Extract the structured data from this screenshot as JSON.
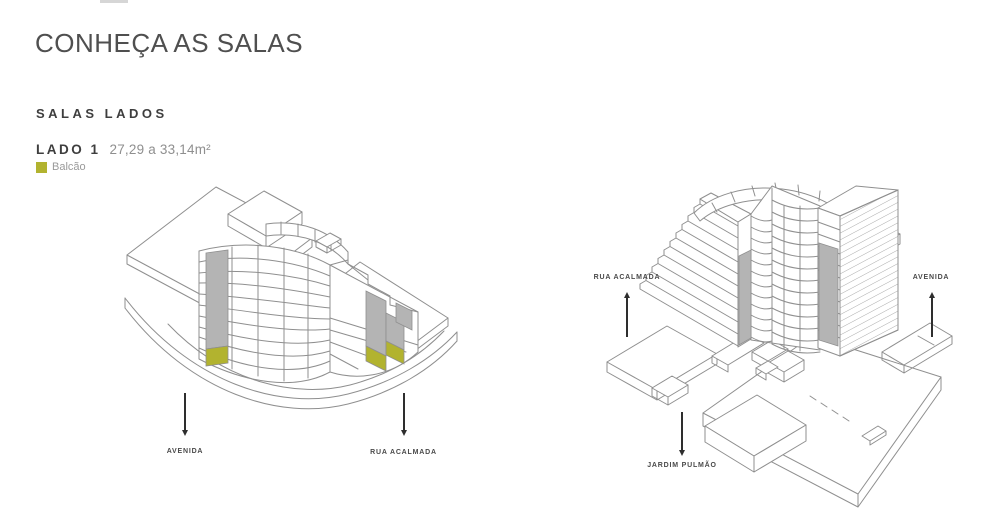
{
  "header": {
    "title": "CONHEÇA AS SALAS"
  },
  "section": {
    "subtitle": "SALAS LADOS",
    "unit": {
      "name": "LADO 1",
      "area_range": "27,29 a 33,14m²"
    },
    "legend": [
      {
        "label": "Balcão",
        "color": "#b2b32f"
      }
    ]
  },
  "figures": {
    "left": {
      "description": "isometric-building-exterior-lado1",
      "labels": [
        {
          "text": "AVENIDA",
          "arrow_direction": "down"
        },
        {
          "text": "RUA ACALMADA",
          "arrow_direction": "down"
        }
      ]
    },
    "right": {
      "description": "isometric-building-courtyard-lado1",
      "labels": [
        {
          "text": "RUA ACALMADA",
          "arrow_direction": "up"
        },
        {
          "text": "AVENIDA",
          "arrow_direction": "up"
        },
        {
          "text": "JARDIM PULMÃO",
          "arrow_direction": "down"
        }
      ]
    }
  },
  "colors": {
    "balcony_olive": "#b2b32f",
    "unit_gray": "#b4b4b4",
    "line_gray": "#8f8f8f",
    "arrow_dark": "#2e2e2e",
    "text_dark": "#3e3e3e",
    "text_muted": "#8f8f8f",
    "text_label": "#4a4a4a"
  }
}
